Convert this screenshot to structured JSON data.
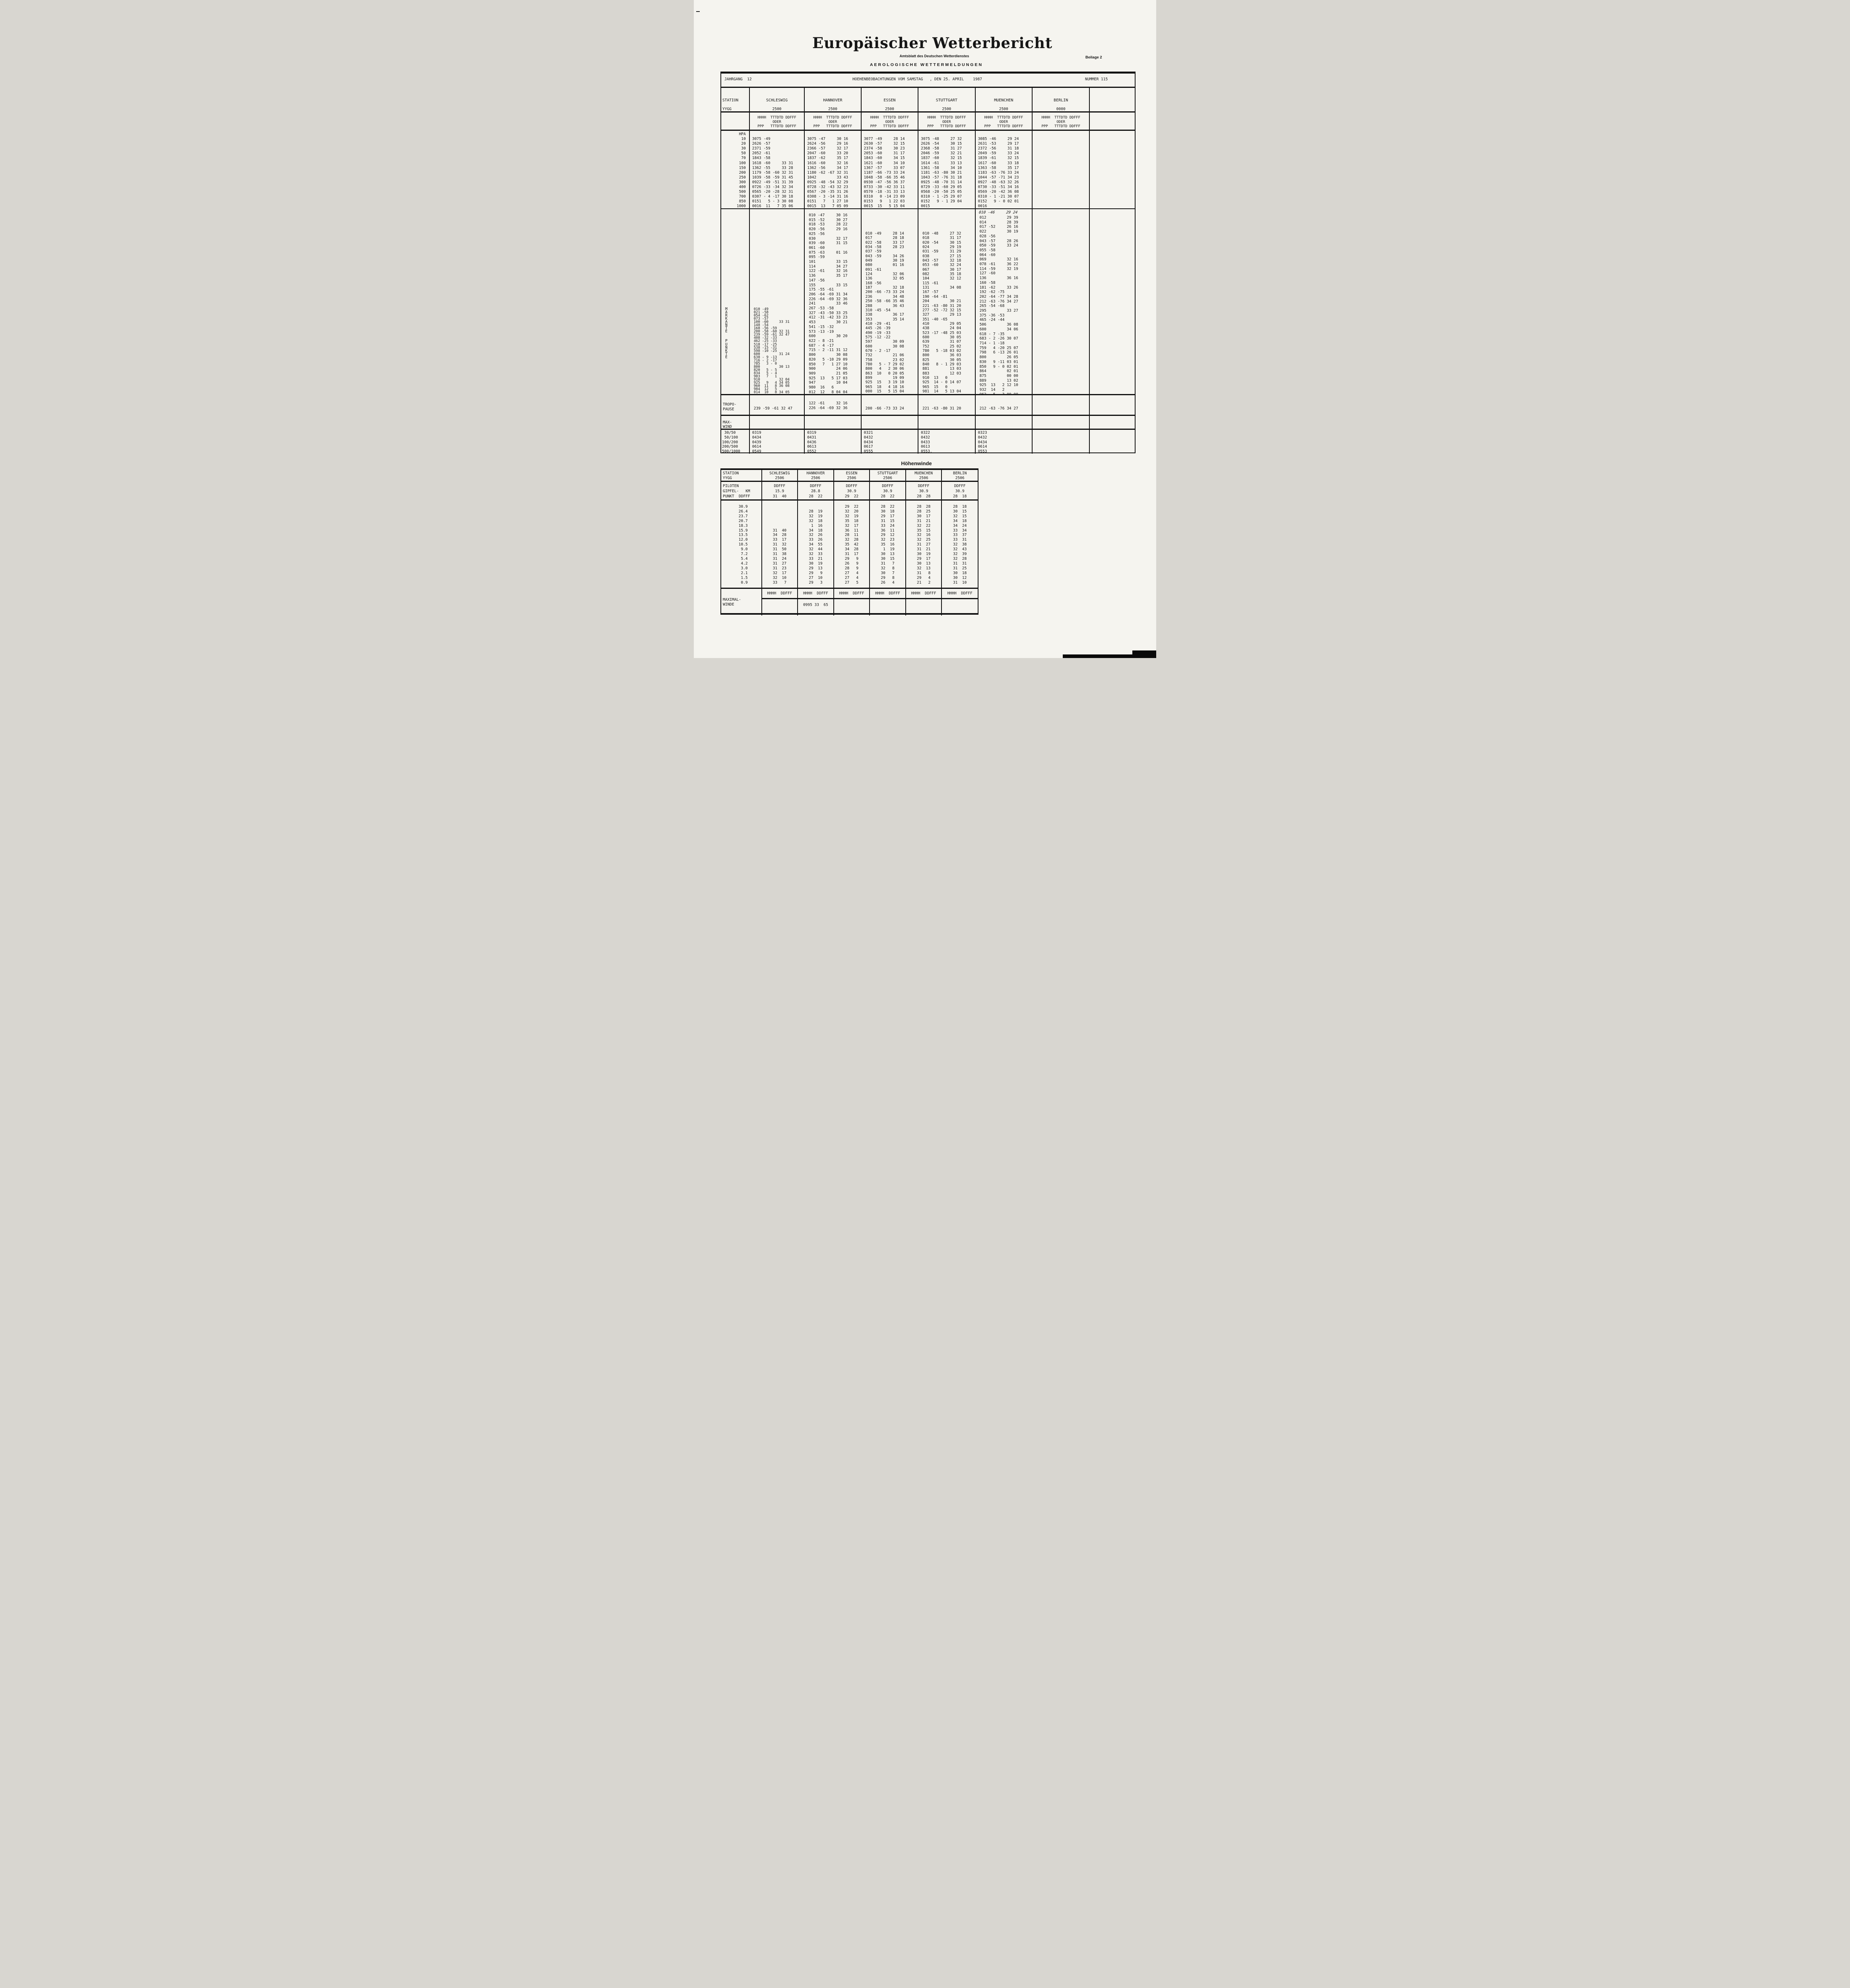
{
  "header": {
    "title": "Europäischer Wetterbericht",
    "subtitle": "Amtsblatt des Deutschen Wetterdienstes",
    "beilage": "Beilage 2",
    "section": "AEROLOGISCHE WETTERMELDUNGEN"
  },
  "table1": {
    "jahrgang": "JAHRGANG  12",
    "beobachtung": "HOEHENBEOBACHTUNGEN VOM SAMSTAG   , DEN 25. APRIL    1987",
    "nummer": "NUMMER 115",
    "station_label": "STATION",
    "yygg_label": "YYGG",
    "hpa_label": "HPA",
    "stations": [
      "SCHLESWIG",
      "HANNOVER",
      "ESSEN",
      "STUTTGART",
      "MUENCHEN",
      "BERLIN"
    ],
    "yygg": [
      "2500",
      "2500",
      "2500",
      "2500",
      "2500",
      "0000"
    ],
    "subheader": [
      "HHHH  TTTDTD DDFFF",
      "ODER",
      "PPP   TTTDTD DDFFF"
    ],
    "hpa_col": [
      "HPA",
      "10",
      "20",
      "30",
      "50",
      "70",
      "100",
      "150",
      "200",
      "250",
      "300",
      "400",
      "500",
      "700",
      "850",
      "1000"
    ],
    "standard": {
      "schleswig": [
        "",
        "3075 -49",
        "2626 -57",
        "2371 -59",
        "2052 -61",
        "1843 -58",
        "1618 -60     33 31",
        "1362 -55     33 28",
        "1179 -58 -60 32 31",
        "1039 -58 -59 31 45",
        "0922 -49 -51 31 39",
        "0726 -33 -34 32 34",
        "0565 -20 -28 32 31",
        "0307 - 4 -17 30 18",
        "0151   5 - 3 30 08",
        "0016  11   7 35 06"
      ],
      "hannover": [
        "",
        "3075 -47     30 16",
        "2624 -56     29 16",
        "2366 -57     32 17",
        "2047 -60     33 20",
        "1837 -62     35 17",
        "1616 -60     32 16",
        "1362 -56     34 17",
        "1180 -62 -67 32 31",
        "1042         33 43",
        "0925 -48 -54 32 29",
        "0728 -32 -43 32 23",
        "0567 -20 -35 31 26",
        "0308 - 3 -14 31 16",
        "0151   7   1 27 10",
        "0015  13   7 05 09"
      ],
      "essen": [
        "",
        "3077 -49     28 14",
        "2630 -57     32 15",
        "2374 -58     30 23",
        "2053 -60     31 17",
        "1843 -60     34 15",
        "1621 -60     34 10",
        "1367 -57     33 07",
        "1187 -66 -73 33 24",
        "1048 -58 -66 35 46",
        "0930 -47 -56 36 37",
        "0733 -30 -42 33 11",
        "0570 -18 -31 33 13",
        "0310   0 -14 23 09",
        "0153   9   1 22 03",
        "0015  15   5 15 04"
      ],
      "stuttgart": [
        "",
        "3075 -48     27 32",
        "2626 -54     30 15",
        "2368 -58     31 27",
        "2046 -59     32 21",
        "1837 -60     32 15",
        "1614 -61     33 13",
        "1361 -58     34 10",
        "1181 -63 -80 30 21",
        "1043 -57 -76 31 18",
        "0925 -48 -70 31 14",
        "0729 -33 -60 29 05",
        "0568 -20 -50 25 05",
        "0310 - 1 -25 29 07",
        "0152   9 - 1 29 04",
        "0015"
      ],
      "muenchen": [
        "",
        "3085 -46     29 24",
        "2631 -53     29 17",
        "2372 -56     31 18",
        "2049 -59     33 24",
        "1839 -61     32 15",
        "1617 -60     33 18",
        "1363 -58     35 17",
        "1183 -63 -76 33 24",
        "1044 -57 -71 34 23",
        "0927 -48 -63 32 26",
        "0730 -33 -51 34 16",
        "0569 -20 -42 36 08",
        "0310 - 1 -21 30 07",
        "0152   9 - 0 02 01",
        "0016"
      ],
      "berlin": [
        ""
      ]
    },
    "markante_letters": [
      "M",
      "A",
      "R",
      "K",
      "A",
      "N",
      "T",
      "E",
      "",
      "",
      "P",
      "U",
      "N",
      "K",
      "T",
      "E"
    ],
    "significant": {
      "schleswig": [
        "010 -49",
        "021 -58",
        "054 -62",
        "073 -57",
        "100 -60     33 31",
        "148 -54",
        "168 -56 -59",
        "200 -58 -60 32 31",
        "239 -59 -61 32 47",
        "408 -32 -33",
        "462 -25 -33",
        "518 -17 -25",
        "538 -15 -31",
        "598 -10 -25",
        "600         31 24",
        "638 - 9 -13",
        "716 - 2 -17",
        "785   3 - 0",
        "800         30 13",
        "820   5 - 5",
        "834   5 - 4",
        "903   7   1",
        "910         32 04",
        "925   9   4 34 05",
        "960  11   8 36 08",
        "984  12   5",
        "014  10   8 34 05"
      ],
      "hannover": [
        "010 -47     30 16",
        "015 -52     30 27",
        "018 -53     28 22",
        "020 -56     29 16",
        "025 -56",
        "030         32 17",
        "039 -60     31 15",
        "061 -60",
        "075 -63     01 16",
        "095 -59",
        "101         33 15",
        "114         34 27",
        "122 -61     32 16",
        "136         35 17",
        "147 -56",
        "155         33 15",
        "175 -55 -61",
        "206 -64 -69 31 34",
        "226 -64 -69 32 36",
        "241         33 46",
        "267 -53 -58",
        "327 -43 -50 33 25",
        "412 -31 -42 33 23",
        "453         30 21",
        "541 -15 -32",
        "573 -13 -19",
        "600         30 20",
        "622 - 8 -21",
        "687 - 4 -17",
        "715 - 2 -11 31 12",
        "800         30 08",
        "820   5 -10 29 09",
        "850   7   1 27 10",
        "900         24 06",
        "909         21 05",
        "925  13   5 17 03",
        "947         10 04",
        "980  16   6",
        "012  12   8 04 04"
      ],
      "essen": [
        "010 -49     28 14",
        "017         28 18",
        "022 -58     33 17",
        "034 -58     28 23",
        "037 -59",
        "043 -59     34 26",
        "049         30 19",
        "080         01 16",
        "091 -61",
        "124         32 06",
        "136         32 05",
        "168 -56",
        "187         32 18",
        "200 -66 -73 33 24",
        "236         34 48",
        "250 -58 -66 35 46",
        "288         36 43",
        "310 -45 -54",
        "338         36 17",
        "353         35 14",
        "410 -29 -41",
        "445 -26 -39",
        "490 -19 -33",
        "575 -12 -22",
        "597         30 09",
        "600         30 08",
        "670 - 2 -17",
        "732         21 06",
        "758         23 02",
        "780   5 - 7 29 02",
        "800   4   2 30 06",
        "863  10   0 20 05",
        "899         19 09",
        "925  15   3 19 10",
        "965  18   4 18 16",
        "000  15   5 15 04"
      ],
      "stuttgart": [
        "010 -48     27 32",
        "018         31 17",
        "020 -54     30 15",
        "024         29 19",
        "031 -59     31 29",
        "038         27 15",
        "043 -57     32 18",
        "053 -60     32 24",
        "067         30 17",
        "082         35 18",
        "104         32 12",
        "115 -61",
        "131         34 08",
        "167 -57",
        "190 -64 -81",
        "204         30 21",
        "221 -63 -80 31 20",
        "277 -52 -72 32 15",
        "327         29 13",
        "351 -40 -65",
        "410         29 05",
        "438         24 04",
        "523 -17 -48 25 03",
        "600         30 05",
        "639         31 07",
        "752         25 02",
        "780   5 -18 03 02",
        "800         36 03",
        "825         30 05",
        "840   8 - 1 29 03",
        "881         13 03",
        "883         12 03",
        "910  13   0",
        "925  14 - 0 14 07",
        "965  15   0",
        "981  14   5 13 04"
      ],
      "muenchen_hand": "010 -46     29 24",
      "muenchen": [
        "012         29 39",
        "014         28 39",
        "017 -52     26 16",
        "022         30 19",
        "028 -56",
        "043 -57     28 26",
        "050 -59     33 24",
        "055 -58",
        "064 -60",
        "069         32 16",
        "078 -61     36 22",
        "114 -59     32 19",
        "127 -60",
        "136         36 16",
        "160 -58",
        "181 -62     33 26",
        "192 -62 -75",
        "202 -64 -77 34 28",
        "212 -63 -76 34 27",
        "265 -54 -68",
        "295         33 27",
        "375 -36 -53",
        "465 -24 -44",
        "506         36 08",
        "600         34 06",
        "618 - 7 -35",
        "683 - 2 -26 30 07",
        "714 - 1 -18",
        "759   4 -20 25 07",
        "798   6 -13 26 01",
        "800         26 05",
        "830   9 -11 03 01",
        "850   9 - 0 02 01",
        "864         02 01",
        "875         00 00",
        "889         13 02",
        "925  13   2 12 10",
        "932  14   2",
        "962   5   3 00 00"
      ],
      "berlin": [
        ""
      ]
    },
    "tropo_label": [
      "TROPO-",
      "PAUSE"
    ],
    "tropopause": {
      "schleswig": "239 -59 -61 32 47",
      "hannover": [
        "122 -61     32 16",
        "226 -64 -69 32 36"
      ],
      "essen": "200 -66 -73 33 24",
      "stuttgart": "221 -63 -80 31 20",
      "muenchen": "212 -63 -76 34 27",
      "berlin": ""
    },
    "maxwind_label": [
      "MAX-",
      "WIND"
    ],
    "band_labels": [
      " 30/50",
      " 50/100",
      "100/200",
      "200/500",
      "500/1000"
    ],
    "bands": {
      "schleswig": [
        "0319",
        "0434",
        "0439",
        "0614",
        "0549"
      ],
      "hannover": [
        "0319",
        "0431",
        "0436",
        "0613",
        "0552"
      ],
      "essen": [
        "0321",
        "0432",
        "0434",
        "0617",
        "0555"
      ],
      "stuttgart": [
        "0322",
        "0432",
        "0433",
        "0613",
        "0553."
      ],
      "muenchen": [
        "0323",
        "0432",
        "0434",
        "0614",
        "0553"
      ],
      "berlin": [
        ""
      ]
    }
  },
  "table2": {
    "title": "Höhenwinde",
    "station_label": "STATION",
    "yygg_label": "YYGG",
    "stations": [
      "SCHLESWIG",
      "HANNOVER",
      "ESSEN",
      "STUTTGART",
      "MUENCHEN",
      "BERLIN"
    ],
    "yygg": [
      "2506",
      "2506",
      "2506",
      "2506",
      "2506",
      "2506"
    ],
    "piloten_label": [
      "PILOTEN",
      "GIPFEL-   KM",
      "PUNKT  DDFFF"
    ],
    "piloten": {
      "schleswig": [
        "DDFFF",
        "15.9",
        "31  40"
      ],
      "hannover": [
        "DDFFF",
        "28.8",
        "28  22"
      ],
      "essen": [
        "DDFFF",
        "30.9",
        "29  22"
      ],
      "stuttgart": [
        "DDFFF",
        "30.9",
        "28  22"
      ],
      "muenchen": [
        "DDFFF",
        "30.9",
        "28  28"
      ],
      "berlin": [
        "DDFFF",
        "30.9",
        "28  18"
      ]
    },
    "altitudes": [
      "30.9",
      "26.4",
      "23.7",
      "20.7",
      "18.3",
      "15.9",
      "13.5",
      "12.0",
      "10.5",
      "9.0",
      "7.2",
      "5.4",
      "4.2",
      "3.0",
      "2.1",
      "1.5",
      "0.9"
    ],
    "winds": {
      "schleswig": [
        "",
        "",
        "",
        "",
        "",
        "31  40",
        "34  28",
        "33  17",
        "31  32",
        "31  50",
        "31  38",
        "31  24",
        "31  27",
        "31  23",
        "32  17",
        "32  10",
        "33   7"
      ],
      "hannover": [
        "",
        "28  19",
        "32  19",
        "32  18",
        " 1  16",
        "34  18",
        "32  26",
        "33  26",
        "34  55",
        "32  44",
        "32  33",
        "33  21",
        "30  19",
        "29  13",
        "29   9",
        "27  10",
        "29   3"
      ],
      "essen": [
        "29  22",
        "32  20",
        "32  19",
        "35  18",
        "32  17",
        "36  11",
        "28  11",
        "32  28",
        "35  42",
        "34  28",
        "31  17",
        "29   9",
        "26   9",
        "28   9",
        "27   4",
        "27   4",
        "27   5"
      ],
      "stuttgart": [
        "28  22",
        "30  18",
        "29  17",
        "31  15",
        "33  24",
        "36  11",
        "29  12",
        "32  23",
        "35  16",
        " 1  19",
        "30  13",
        "30  15",
        "31   7",
        "32   8",
        "30   7",
        "29   8",
        "26   4"
      ],
      "muenchen": [
        "28  28",
        "28  25",
        "30  17",
        "31  21",
        "32  22",
        "35  15",
        "32  16",
        "32  25",
        "31  27",
        "31  21",
        "30  19",
        "29  17",
        "30  13",
        "32  13",
        "31   8",
        "29   4",
        "21   2"
      ],
      "berlin": [
        "28  18",
        "30  15",
        "32  15",
        "34  18",
        "34  24",
        "33  34",
        "33  37",
        "33  31",
        "32  38",
        "32  43",
        "32  39",
        "32  28",
        "31  31",
        "31  25",
        "30  18",
        "30  12",
        "31  10"
      ]
    },
    "maximal_label": [
      "MAXIMAL-",
      "WINDE"
    ],
    "hhhh_header": "HHHH  DDFFF",
    "max_values": {
      "schleswig": "",
      "hannover": "0995 33  65",
      "essen": "",
      "stuttgart": "",
      "muenchen": "",
      "berlin": ""
    }
  }
}
